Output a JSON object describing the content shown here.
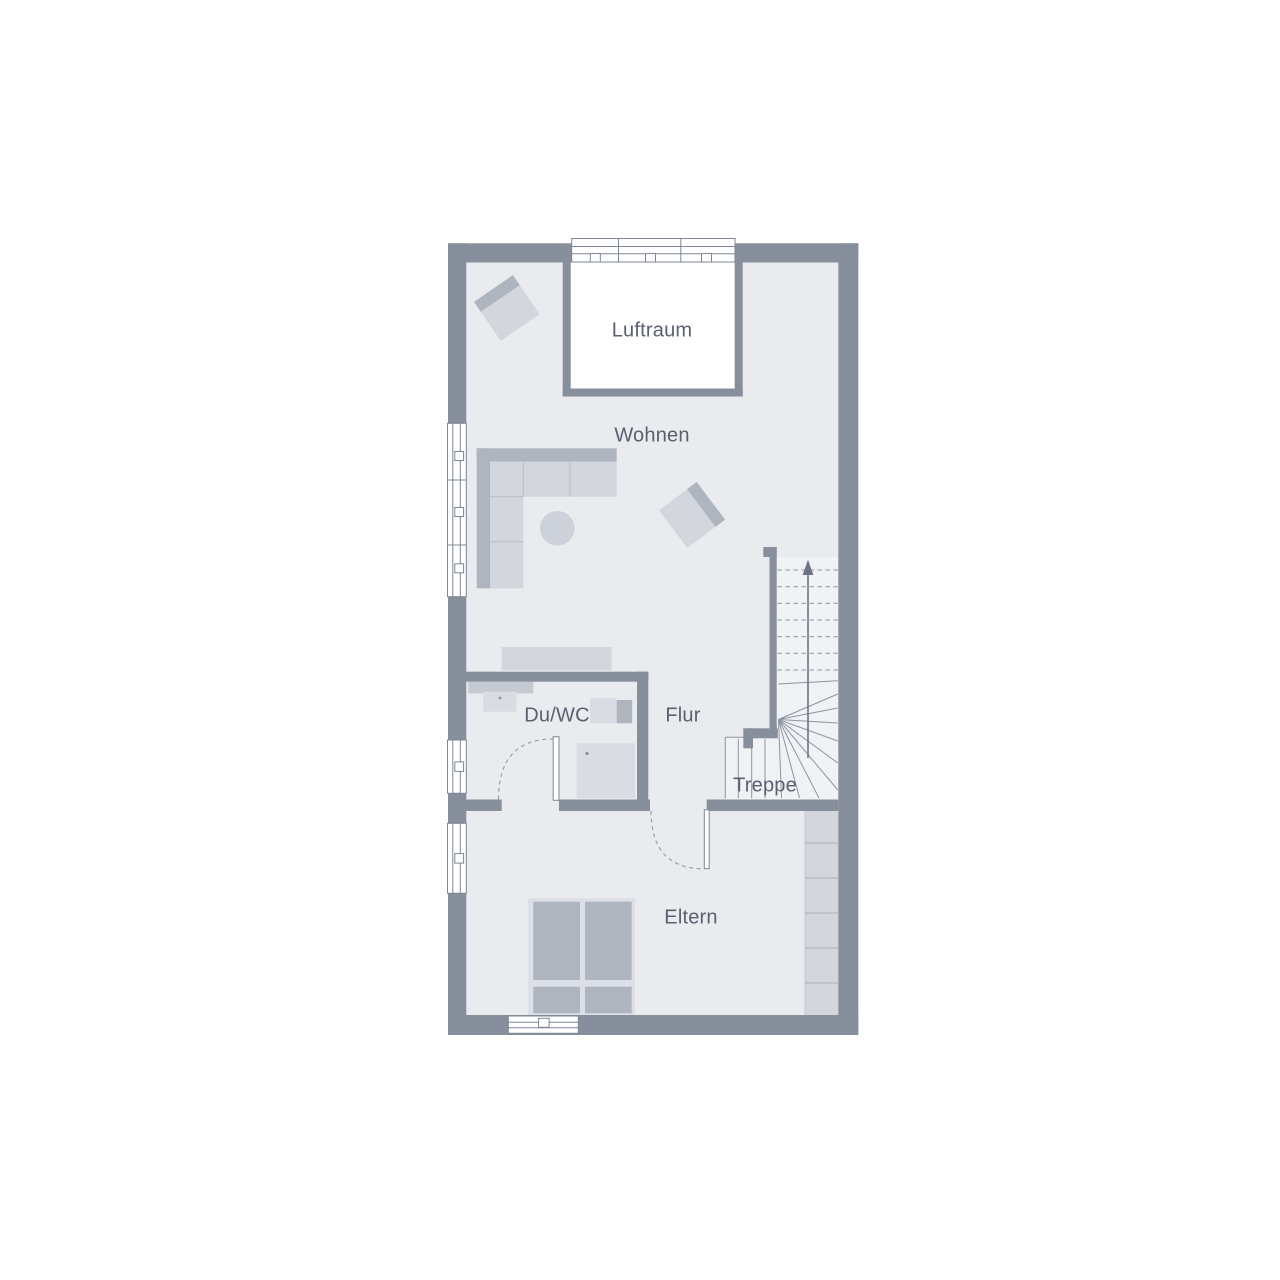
{
  "type": "floor-plan",
  "floor": "upper-floor",
  "labels": {
    "luftraum": "Luftraum",
    "wohnen": "Wohnen",
    "du_wc": "Du/WC",
    "flur": "Flur",
    "treppe": "Treppe",
    "eltern": "Eltern"
  },
  "icons": {
    "stair_direction_arrow": "up-arrow"
  },
  "colors": {
    "background": "#ffffff",
    "wall": "#878f9d",
    "floor": "#e9ebee",
    "stair_floor": "#f1f2f5",
    "furniture_light": "#d3d6dd",
    "furniture_dark": "#aeb5bf",
    "fixture": "#d9dce2",
    "outline": "#7f8795",
    "text": "#596170"
  }
}
